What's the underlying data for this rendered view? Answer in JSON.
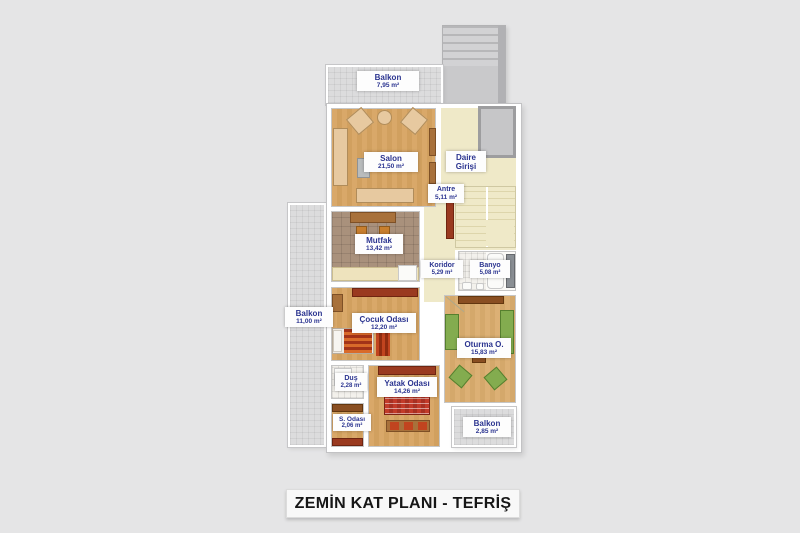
{
  "title": "ZEMİN KAT PLANI - TEFRİŞ",
  "rooms": {
    "balkon_top": {
      "name": "Balkon",
      "area": "7,95 m²"
    },
    "salon": {
      "name": "Salon",
      "area": "21,50 m²"
    },
    "daire_girisi": {
      "name": "Daire Girişi"
    },
    "antre": {
      "name": "Antre",
      "area": "5,11 m²"
    },
    "mutfak": {
      "name": "Mutfak",
      "area": "13,42 m²"
    },
    "koridor": {
      "name": "Koridor",
      "area": "5,29 m²"
    },
    "banyo": {
      "name": "Banyo",
      "area": "5,08 m²"
    },
    "balkon_left": {
      "name": "Balkon",
      "area": "11,00 m²"
    },
    "cocuk": {
      "name": "Çocuk Odası",
      "area": "12,20 m²"
    },
    "oturma": {
      "name": "Oturma O.",
      "area": "15,83 m²"
    },
    "dus": {
      "name": "Duş",
      "area": "2,28 m²"
    },
    "yatak": {
      "name": "Yatak Odası",
      "area": "14,26 m²"
    },
    "s_odasi": {
      "name": "S. Odası",
      "area": "2,06 m²"
    },
    "balkon_br": {
      "name": "Balkon",
      "area": "2,85 m²"
    }
  },
  "colors": {
    "background": "#e5e5e6",
    "wall": "#ffffff",
    "wood_floor": "#d9a869",
    "kitchen_tile": "#a9917c",
    "hall_cream": "#efe9c8",
    "balcony_tile": "#dcdcdd",
    "label_text": "#2b3490",
    "furniture_red": "#9a3a20",
    "furniture_green": "#83ac4f",
    "title_text": "#161616"
  }
}
